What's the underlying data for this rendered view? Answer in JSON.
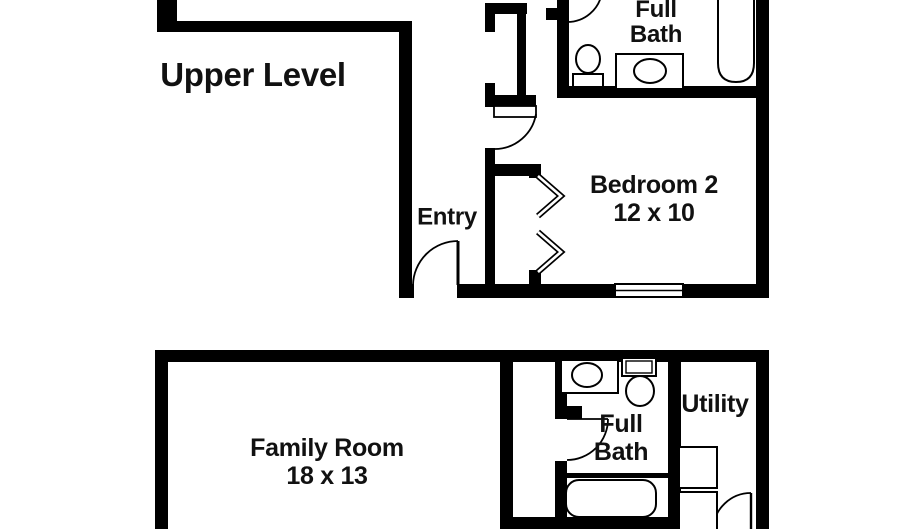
{
  "upper_level": {
    "name": "Upper Level",
    "rooms": {
      "full_bath": "Full Bath",
      "bedroom": "Bedroom 2",
      "bedroom_dims": "12 x 10",
      "entry": "Entry"
    }
  },
  "lower_level": {
    "rooms": {
      "family_room": "Family Room",
      "family_room_dims": "18 x 13",
      "full_bath": "Full Bath",
      "utility": "Utility"
    }
  },
  "colors": {
    "wall": "#000000",
    "background": "#ffffff",
    "text": "#111111"
  }
}
